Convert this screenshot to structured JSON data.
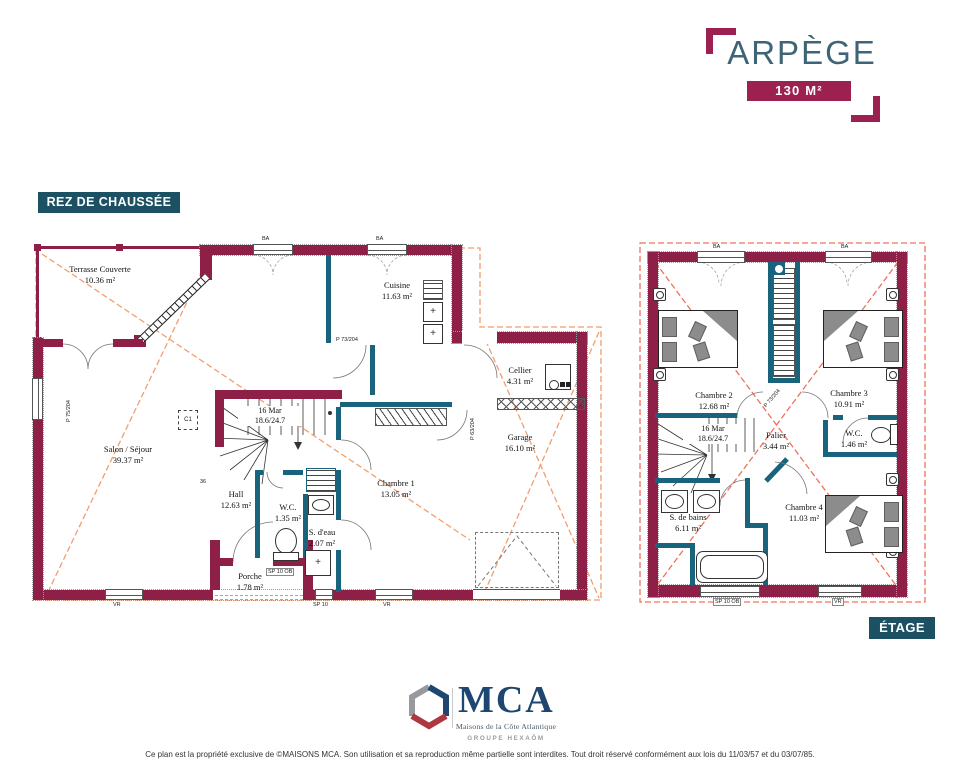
{
  "header": {
    "title": "ARPÈGE",
    "area_badge": "130 M²"
  },
  "floor_labels": {
    "ground": "REZ DE CHAUSSÉE",
    "upper": "ÉTAGE"
  },
  "ground_floor": {
    "rooms": {
      "terrasse": {
        "name": "Terrasse Couverte",
        "area": "10.36 m²"
      },
      "cuisine": {
        "name": "Cuisine",
        "area": "11.63 m²"
      },
      "cellier": {
        "name": "Cellier",
        "area": "4.31 m²"
      },
      "garage": {
        "name": "Garage",
        "area": "16.10 m²"
      },
      "salon": {
        "name": "Salon / Séjour",
        "area": "39.37 m²"
      },
      "hall": {
        "name": "Hall",
        "area": "12.63 m²"
      },
      "wc": {
        "name": "W.C.",
        "area": "1.35 m²"
      },
      "sdeau": {
        "name": "S. d'eau",
        "area": "2.07 m²"
      },
      "chambre1": {
        "name": "Chambre 1",
        "area": "13.05 m²"
      },
      "porche": {
        "name": "Porche",
        "area": "1.78 m²"
      }
    },
    "stairs": {
      "line1": "16 Mar",
      "line2": "18.6/24.7"
    },
    "annotations": {
      "dim": "36",
      "c1": "C1"
    }
  },
  "upper_floor": {
    "rooms": {
      "chambre2": {
        "name": "Chambre 2",
        "area": "12.68 m²"
      },
      "chambre3": {
        "name": "Chambre 3",
        "area": "10.91 m²"
      },
      "palier": {
        "name": "Palier",
        "area": "3.44 m²"
      },
      "wc": {
        "name": "W.C.",
        "area": "1.46 m²"
      },
      "sdb": {
        "name": "S. de bains",
        "area": "6.11 m²"
      },
      "chambre4": {
        "name": "Chambre 4",
        "area": "11.03 m²"
      }
    },
    "stairs": {
      "line1": "16 Mar",
      "line2": "18.6/24.7"
    }
  },
  "window_labels": {
    "vr": "VR",
    "sp10": "SP 10",
    "sp10ob": "SP 10 OB",
    "ba": "BA"
  },
  "door_labels": {
    "p73": "P 73/204",
    "p75": "P 75/204",
    "p63": "P 63/204"
  },
  "logo": {
    "acronym": "MCA",
    "tagline": "Maisons de la Côte Atlantique",
    "group": "GROUPE HEXAŌM"
  },
  "footer": "Ce plan est la propriété exclusive de ©MAISONS MCA. Son utilisation et sa reproduction même partielle sont interdites. Tout droit réservé conformément aux lois du 11/03/57 et du 03/07/85.",
  "colors": {
    "wall": "#8e2048",
    "teal": "#19647c",
    "accent": "#9c2150",
    "title": "#3e6577",
    "floor_badge": "#1b5162",
    "dash_orange": "#f29e6d",
    "dash_red": "#f2705a",
    "navy": "#1d4671"
  }
}
